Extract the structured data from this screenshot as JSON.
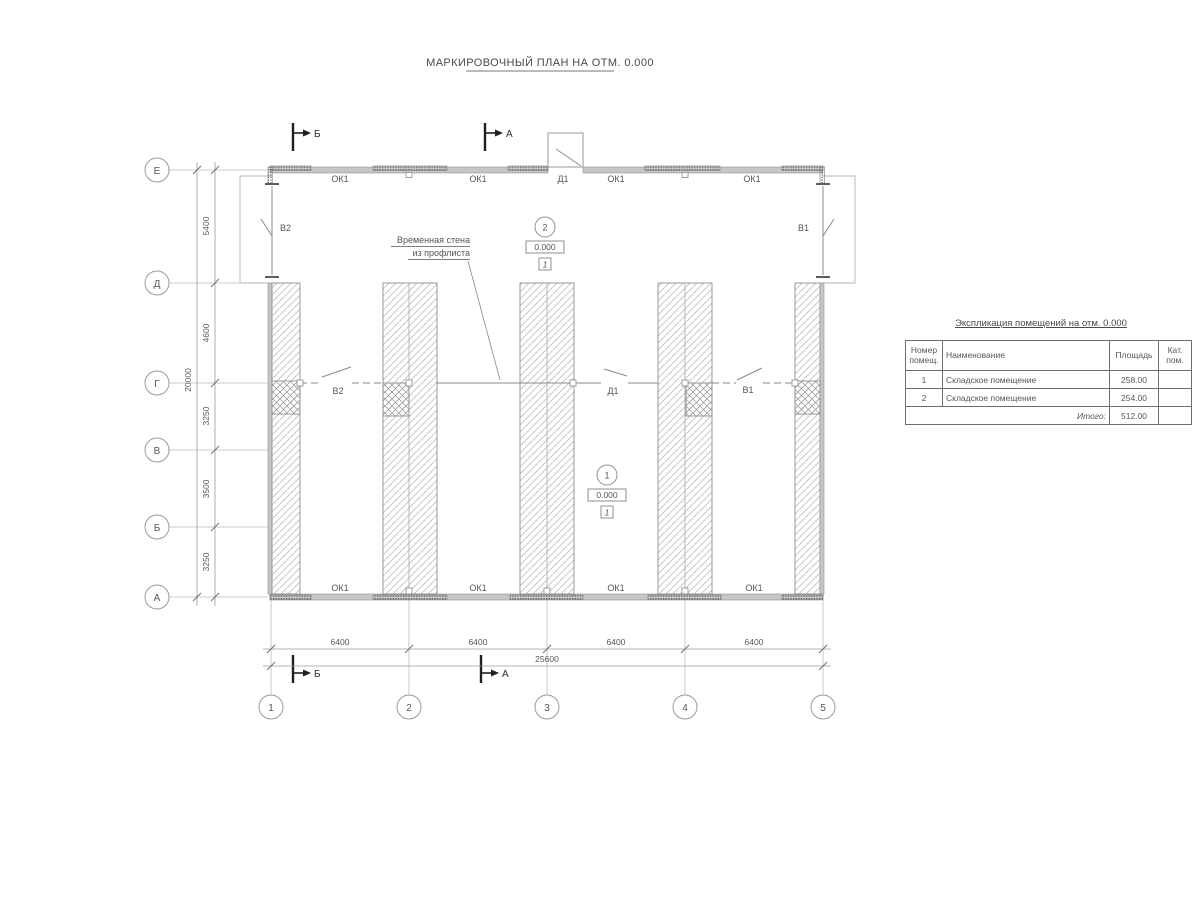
{
  "title": "МАРКИРОВОЧНЫЙ ПЛАН НА ОТМ. 0.000",
  "colors": {
    "line": "#8c8c8c",
    "wall_fill": "#c6c6c6",
    "text": "#565656",
    "flag": "#1f1f1f"
  },
  "axes": {
    "rows": [
      "Е",
      "Д",
      "Г",
      "В",
      "Б",
      "А"
    ],
    "cols": [
      "1",
      "2",
      "3",
      "4",
      "5"
    ]
  },
  "dims": {
    "v": [
      "5400",
      "4600",
      "3250",
      "3500",
      "3250"
    ],
    "v_total": "20000",
    "h": [
      "6400",
      "6400",
      "6400",
      "6400"
    ],
    "h_total": "25600"
  },
  "plan": {
    "top_labels": [
      "ОК1",
      "ОК1",
      "Д1",
      "ОК1",
      "ОК1"
    ],
    "bottom_labels": [
      "ОК1",
      "ОК1",
      "ОК1",
      "ОК1"
    ],
    "door": "Д1",
    "gate_left": "В2",
    "gate_right": "В1",
    "note_line1": "Временная стена",
    "note_line2": "из профлиста",
    "sections": {
      "a": "А",
      "b": "Б"
    },
    "markers": [
      {
        "num": "1",
        "level": "0.000",
        "floor": "1"
      },
      {
        "num": "2",
        "level": "0.000",
        "floor": "1"
      }
    ]
  },
  "table": {
    "title": "Экспликация помещений на отм. 0.000",
    "headers": [
      "Номер помещ.",
      "Наименование",
      "Площадь",
      "Кат. пом."
    ],
    "rows": [
      {
        "num": "1",
        "name": "Складское помещение",
        "area": "258.00",
        "cat": ""
      },
      {
        "num": "2",
        "name": "Складское помещение",
        "area": "254.00",
        "cat": ""
      }
    ],
    "total_label": "Итого:",
    "total_value": "512.00"
  }
}
